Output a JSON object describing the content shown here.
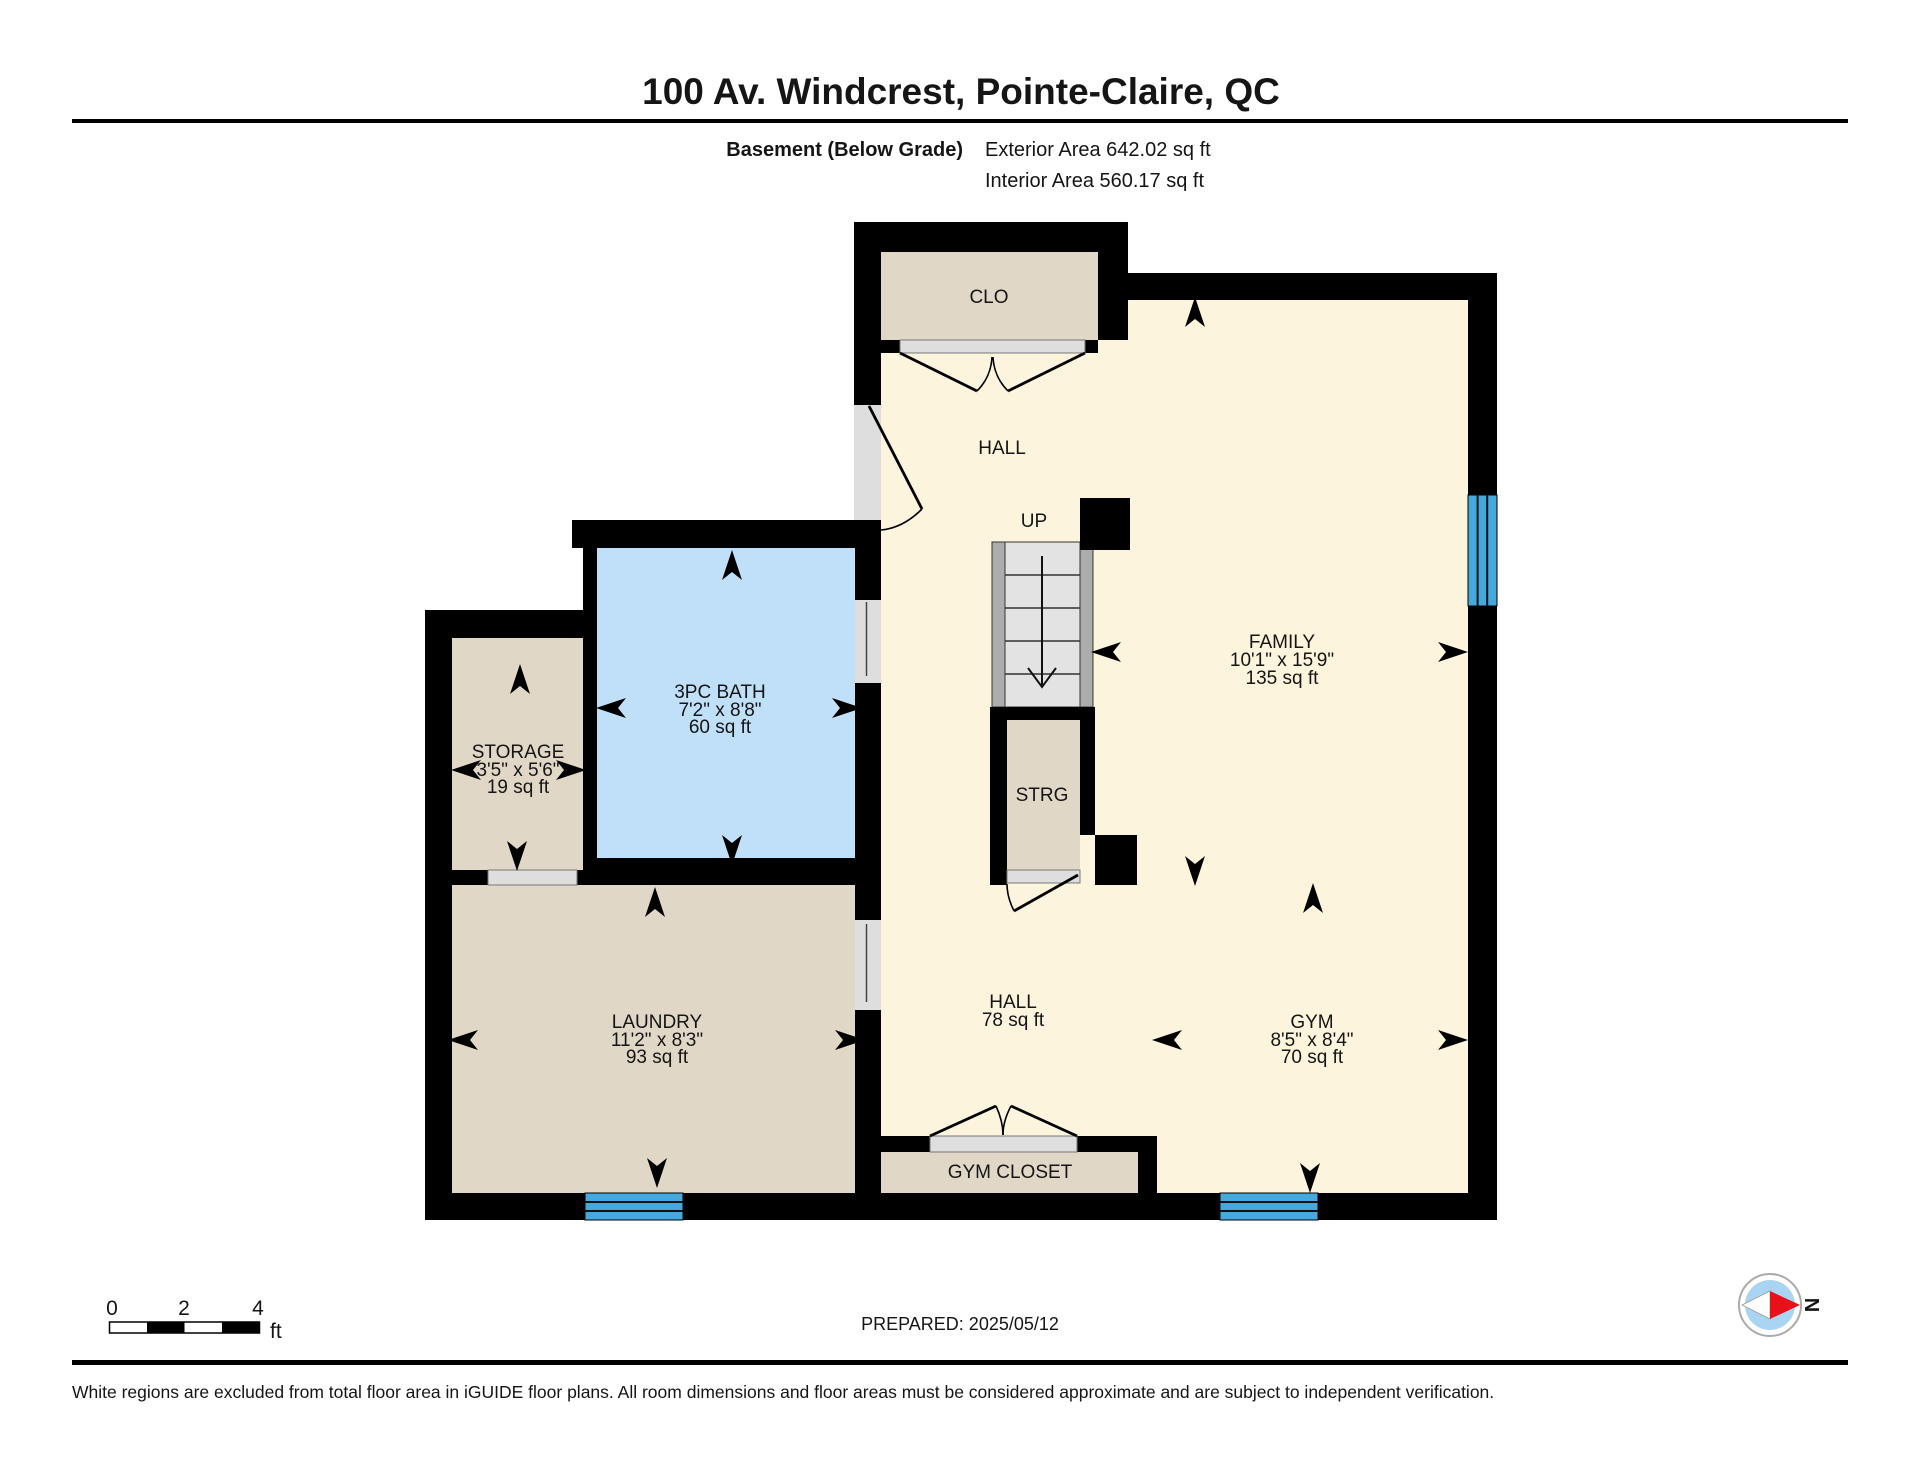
{
  "header": {
    "title": "100 Av. Windcrest, Pointe-Claire, QC",
    "floor_label": "Basement (Below Grade)",
    "exterior_area": "Exterior Area 642.02 sq ft",
    "interior_area": "Interior Area 560.17 sq ft"
  },
  "rooms": {
    "clo": {
      "label": "CLO"
    },
    "hall_upper": {
      "label": "HALL"
    },
    "stairs": {
      "label": "UP"
    },
    "family": {
      "label": "FAMILY",
      "dimensions": "10'1\" x 15'9\"",
      "area": "135 sq ft"
    },
    "bath": {
      "label": "3PC BATH",
      "dimensions": "7'2\" x 8'8\"",
      "area": "60 sq ft"
    },
    "storage": {
      "label": "STORAGE",
      "dimensions": "3'5\" x 5'6\"",
      "area": "19 sq ft"
    },
    "strg": {
      "label": "STRG"
    },
    "laundry": {
      "label": "LAUNDRY",
      "dimensions": "11'2\" x 8'3\"",
      "area": "93 sq ft"
    },
    "hall_lower": {
      "label": "HALL",
      "area": "78 sq ft"
    },
    "gym": {
      "label": "GYM",
      "dimensions": "8'5\" x 8'4\"",
      "area": "70 sq ft"
    },
    "gym_closet": {
      "label": "GYM CLOSET"
    }
  },
  "arrows": [
    {
      "x": 1195,
      "y": 313,
      "dir": "up"
    },
    {
      "x": 732,
      "y": 566,
      "dir": "up"
    },
    {
      "x": 612,
      "y": 708,
      "dir": "left"
    },
    {
      "x": 846,
      "y": 708,
      "dir": "right"
    },
    {
      "x": 732,
      "y": 849,
      "dir": "down"
    },
    {
      "x": 520,
      "y": 680,
      "dir": "up"
    },
    {
      "x": 467,
      "y": 770,
      "dir": "left"
    },
    {
      "x": 570,
      "y": 770,
      "dir": "right"
    },
    {
      "x": 517,
      "y": 855,
      "dir": "down"
    },
    {
      "x": 1107,
      "y": 652,
      "dir": "left"
    },
    {
      "x": 1452,
      "y": 652,
      "dir": "right"
    },
    {
      "x": 1195,
      "y": 870,
      "dir": "down"
    },
    {
      "x": 655,
      "y": 903,
      "dir": "up"
    },
    {
      "x": 464,
      "y": 1040,
      "dir": "left"
    },
    {
      "x": 849,
      "y": 1040,
      "dir": "right"
    },
    {
      "x": 657,
      "y": 1172,
      "dir": "down"
    },
    {
      "x": 1313,
      "y": 899,
      "dir": "up"
    },
    {
      "x": 1168,
      "y": 1040,
      "dir": "left"
    },
    {
      "x": 1452,
      "y": 1040,
      "dir": "right"
    },
    {
      "x": 1310,
      "y": 1177,
      "dir": "down"
    }
  ],
  "scale_bar": {
    "tick0": "0",
    "tick2": "2",
    "tick4": "4",
    "unit": "ft"
  },
  "footer": {
    "prepared": "PREPARED: 2025/05/12",
    "disclaimer": "White regions are excluded from total floor area in iGUIDE floor plans. All room dimensions and floor areas must be considered approximate and are subject to independent verification.",
    "compass_label": "N"
  },
  "colors": {
    "wall": "#000000",
    "floor_cream": "#FCF4DC",
    "room_tan": "#E0D7C7",
    "bath_blue": "#BFE0F8",
    "window_blue": "#45A9DE",
    "stair_rail": "#ACACAC",
    "stair_tread": "#E3E3E3",
    "door_gray": "#DEDEDE",
    "compass_red": "#E8111A",
    "compass_blue": "#A9D4F2"
  }
}
